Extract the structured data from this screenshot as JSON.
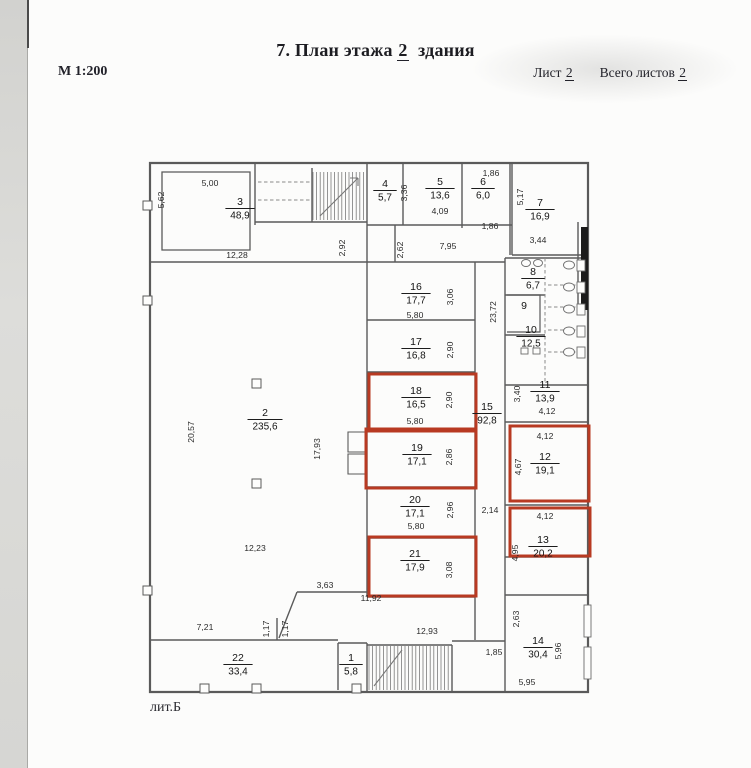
{
  "header": {
    "title_prefix": "7. План этажа",
    "title_number": "2",
    "title_suffix": "здания",
    "scale": "М 1:200",
    "sheet_label": "Лист",
    "sheet_number": "2",
    "total_label": "Всего листов",
    "total_number": "2"
  },
  "footer": {
    "building_label": "лит.Б"
  },
  "colors": {
    "highlight": "#b83a22",
    "wall": "#5a5a5a",
    "text": "#141414"
  },
  "plan": {
    "rooms": [
      {
        "number": "1",
        "area": "5,8",
        "x": 351,
        "y": 661,
        "highlighted": false
      },
      {
        "number": "2",
        "area": "235,6",
        "x": 265,
        "y": 416,
        "highlighted": false
      },
      {
        "number": "3",
        "area": "48,9",
        "x": 240,
        "y": 205,
        "highlighted": false
      },
      {
        "number": "4",
        "area": "5,7",
        "x": 385,
        "y": 187,
        "highlighted": false
      },
      {
        "number": "5",
        "area": "13,6",
        "x": 440,
        "y": 185,
        "highlighted": false
      },
      {
        "number": "6",
        "area": "6,0",
        "x": 483,
        "y": 185,
        "highlighted": false
      },
      {
        "number": "7",
        "area": "16,9",
        "x": 540,
        "y": 206,
        "highlighted": false
      },
      {
        "number": "8",
        "area": "6,7",
        "x": 533,
        "y": 275,
        "highlighted": false
      },
      {
        "number": "9",
        "area": null,
        "x": 524,
        "y": 309,
        "highlighted": false
      },
      {
        "number": "10",
        "area": "12,5",
        "x": 531,
        "y": 333,
        "highlighted": false
      },
      {
        "number": "11",
        "area": "13,9",
        "x": 545,
        "y": 388,
        "highlighted": false
      },
      {
        "number": "12",
        "area": "19,1",
        "x": 545,
        "y": 460,
        "highlighted": true
      },
      {
        "number": "13",
        "area": "20,2",
        "x": 543,
        "y": 543,
        "highlighted": true
      },
      {
        "number": "14",
        "area": "30,4",
        "x": 538,
        "y": 644,
        "highlighted": false
      },
      {
        "number": "15",
        "area": "92,8",
        "x": 487,
        "y": 410,
        "highlighted": false
      },
      {
        "number": "16",
        "area": "17,7",
        "x": 416,
        "y": 290,
        "highlighted": false
      },
      {
        "number": "17",
        "area": "16,8",
        "x": 416,
        "y": 345,
        "highlighted": false
      },
      {
        "number": "18",
        "area": "16,5",
        "x": 416,
        "y": 394,
        "highlighted": true
      },
      {
        "number": "19",
        "area": "17,1",
        "x": 417,
        "y": 451,
        "highlighted": true
      },
      {
        "number": "20",
        "area": "17,1",
        "x": 415,
        "y": 503,
        "highlighted": false
      },
      {
        "number": "21",
        "area": "17,9",
        "x": 415,
        "y": 557,
        "highlighted": true
      },
      {
        "number": "22",
        "area": "33,4",
        "x": 238,
        "y": 661,
        "highlighted": false
      }
    ],
    "dimensions": [
      {
        "text": "5,00",
        "x": 210,
        "y": 186,
        "rot": false
      },
      {
        "text": "5,62",
        "x": 164,
        "y": 200,
        "rot": true
      },
      {
        "text": "12,28",
        "x": 237,
        "y": 258,
        "rot": false
      },
      {
        "text": "3,36",
        "x": 407,
        "y": 193,
        "rot": true
      },
      {
        "text": "1,86",
        "x": 491,
        "y": 176,
        "rot": false
      },
      {
        "text": "4,09",
        "x": 440,
        "y": 214,
        "rot": false
      },
      {
        "text": "1,86",
        "x": 490,
        "y": 229,
        "rot": false
      },
      {
        "text": "5,17",
        "x": 523,
        "y": 197,
        "rot": true
      },
      {
        "text": "3,44",
        "x": 538,
        "y": 243,
        "rot": false
      },
      {
        "text": "2,92",
        "x": 345,
        "y": 248,
        "rot": true
      },
      {
        "text": "2,62",
        "x": 403,
        "y": 250,
        "rot": true
      },
      {
        "text": "7,95",
        "x": 448,
        "y": 249,
        "rot": false
      },
      {
        "text": "23,72",
        "x": 496,
        "y": 312,
        "rot": true
      },
      {
        "text": "3,06",
        "x": 453,
        "y": 297,
        "rot": true
      },
      {
        "text": "5,80",
        "x": 415,
        "y": 318,
        "rot": false
      },
      {
        "text": "2,90",
        "x": 453,
        "y": 350,
        "rot": true
      },
      {
        "text": "2,90",
        "x": 452,
        "y": 400,
        "rot": true
      },
      {
        "text": "5,80",
        "x": 415,
        "y": 424,
        "rot": false
      },
      {
        "text": "2,86",
        "x": 452,
        "y": 457,
        "rot": true
      },
      {
        "text": "3,40",
        "x": 520,
        "y": 394,
        "rot": true
      },
      {
        "text": "4,12",
        "x": 547,
        "y": 414,
        "rot": false
      },
      {
        "text": "4,12",
        "x": 545,
        "y": 439,
        "rot": false
      },
      {
        "text": "4,67",
        "x": 521,
        "y": 467,
        "rot": true
      },
      {
        "text": "4,12",
        "x": 545,
        "y": 519,
        "rot": false
      },
      {
        "text": "4,95",
        "x": 518,
        "y": 553,
        "rot": true
      },
      {
        "text": "2,96",
        "x": 453,
        "y": 510,
        "rot": true
      },
      {
        "text": "5,80",
        "x": 416,
        "y": 529,
        "rot": false
      },
      {
        "text": "2,14",
        "x": 490,
        "y": 513,
        "rot": false
      },
      {
        "text": "3,08",
        "x": 452,
        "y": 570,
        "rot": true
      },
      {
        "text": "12,23",
        "x": 255,
        "y": 551,
        "rot": false
      },
      {
        "text": "20,57",
        "x": 194,
        "y": 432,
        "rot": true
      },
      {
        "text": "17,93",
        "x": 320,
        "y": 449,
        "rot": true
      },
      {
        "text": "3,63",
        "x": 325,
        "y": 588,
        "rot": false
      },
      {
        "text": "11,92",
        "x": 371,
        "y": 601,
        "rot": false
      },
      {
        "text": "7,21",
        "x": 205,
        "y": 630,
        "rot": false
      },
      {
        "text": "1,17",
        "x": 269,
        "y": 629,
        "rot": true
      },
      {
        "text": "1,17",
        "x": 288,
        "y": 629,
        "rot": true
      },
      {
        "text": "12,93",
        "x": 427,
        "y": 634,
        "rot": false
      },
      {
        "text": "1,85",
        "x": 494,
        "y": 655,
        "rot": false
      },
      {
        "text": "2,63",
        "x": 519,
        "y": 619,
        "rot": true
      },
      {
        "text": "5,96",
        "x": 561,
        "y": 651,
        "rot": true
      },
      {
        "text": "5,95",
        "x": 527,
        "y": 685,
        "rot": false
      }
    ],
    "highlight_boxes": [
      {
        "room": "18",
        "x": 369,
        "y": 374,
        "w": 107,
        "h": 57
      },
      {
        "room": "19",
        "x": 366,
        "y": 429,
        "w": 110,
        "h": 59
      },
      {
        "room": "21",
        "x": 369,
        "y": 537,
        "w": 107,
        "h": 59
      },
      {
        "room": "12",
        "x": 510,
        "y": 426,
        "w": 79,
        "h": 75
      },
      {
        "room": "13",
        "x": 510,
        "y": 508,
        "w": 80,
        "h": 48
      }
    ]
  }
}
